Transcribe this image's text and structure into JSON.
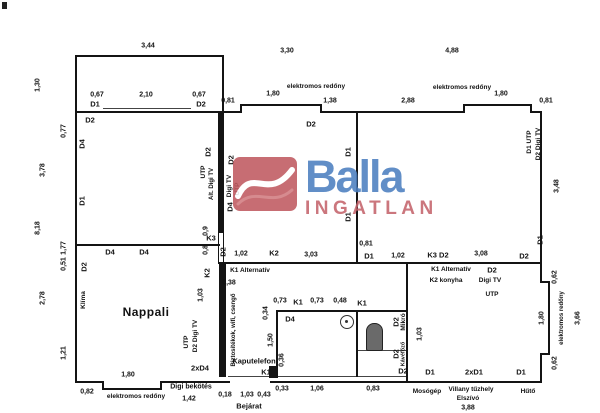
{
  "logo": {
    "brand": "Balla",
    "sub": "INGATLAN",
    "colors": {
      "blue": "#4c7fc0",
      "red": "#c05a60",
      "sub_red": "#c4646c"
    }
  },
  "plan": {
    "line_color": "#141414",
    "rooms": [
      "Nappali",
      "K2 konyha"
    ],
    "walls": [
      [
        75,
        55,
        149,
        58,
        "O",
        "balcony-outline"
      ],
      [
        75,
        111,
        167,
        2,
        "",
        "top-wall"
      ],
      [
        240,
        104,
        2,
        9,
        "",
        "top-wall-step"
      ],
      [
        240,
        104,
        82,
        2,
        "",
        "top-window-recess"
      ],
      [
        320,
        104,
        2,
        9,
        "",
        "top-wall-step"
      ],
      [
        320,
        111,
        145,
        2,
        "",
        "top-wall"
      ],
      [
        463,
        104,
        2,
        9,
        "",
        "top-wall-step"
      ],
      [
        463,
        104,
        69,
        2,
        "",
        "top-window-recess"
      ],
      [
        530,
        104,
        2,
        9,
        "",
        "top-wall-step"
      ],
      [
        530,
        111,
        12,
        2,
        "",
        "top-wall"
      ],
      [
        103,
        108,
        88,
        1,
        "t",
        "balcony-door-line"
      ],
      [
        75,
        111,
        2,
        272,
        "",
        "left-wall"
      ],
      [
        75,
        381,
        29,
        2,
        "",
        "bottom-wall"
      ],
      [
        102,
        381,
        2,
        9,
        "",
        "bottom-wall-step"
      ],
      [
        102,
        388,
        60,
        2,
        "",
        "bottom-window-recess"
      ],
      [
        160,
        381,
        2,
        9,
        "",
        "bottom-wall-step"
      ],
      [
        160,
        381,
        70,
        2,
        "",
        "bottom-wall"
      ],
      [
        228,
        376,
        46,
        1,
        "t",
        "entry-threshold"
      ],
      [
        270,
        381,
        272,
        2,
        "",
        "bottom-wall"
      ],
      [
        540,
        111,
        2,
        172,
        "",
        "right-wall"
      ],
      [
        540,
        281,
        10,
        2,
        "",
        "right-wall-step"
      ],
      [
        548,
        283,
        2,
        72,
        "",
        "right-window-recess"
      ],
      [
        540,
        353,
        10,
        2,
        "",
        "right-wall-step"
      ],
      [
        540,
        355,
        2,
        28,
        "",
        "right-wall"
      ],
      [
        218,
        111,
        6,
        121,
        "",
        "interior-thick-wall"
      ],
      [
        218,
        232,
        6,
        32,
        "o",
        "k3-window"
      ],
      [
        75,
        244,
        145,
        2,
        "",
        "nappali-top-wall"
      ],
      [
        218,
        262,
        324,
        2,
        "",
        "middle-wall"
      ],
      [
        356,
        111,
        2,
        153,
        "",
        "room-divider-wall"
      ],
      [
        219,
        264,
        7,
        113,
        "",
        "hall-thick-wall"
      ],
      [
        276,
        310,
        131,
        2,
        "",
        "bathroom-top-wall"
      ],
      [
        276,
        310,
        2,
        68,
        "",
        "bathroom-left-wall"
      ],
      [
        276,
        376,
        131,
        1,
        "t",
        "bathroom-bottom-wall"
      ],
      [
        356,
        310,
        2,
        67,
        "",
        "bathroom-divider"
      ],
      [
        358,
        350,
        49,
        1,
        "t",
        "wc-shelf-line"
      ],
      [
        406,
        264,
        2,
        119,
        "",
        "kitchen-wall"
      ]
    ],
    "labels": [
      {
        "s": "3,44",
        "x": 148,
        "y": 46,
        "t": "dim"
      },
      {
        "s": "3,30",
        "x": 287,
        "y": 51,
        "t": "dim"
      },
      {
        "s": "4,88",
        "x": 452,
        "y": 51,
        "t": "dim"
      },
      {
        "s": "elektromos redőny",
        "x": 316,
        "y": 87,
        "t": "note"
      },
      {
        "s": "1,80",
        "x": 273,
        "y": 94,
        "t": "dim"
      },
      {
        "s": "1,38",
        "x": 330,
        "y": 101,
        "t": "dim"
      },
      {
        "s": "2,88",
        "x": 408,
        "y": 101,
        "t": "dim"
      },
      {
        "s": "elektromos redőny",
        "x": 462,
        "y": 88,
        "t": "note"
      },
      {
        "s": "1,80",
        "x": 501,
        "y": 94,
        "t": "dim"
      },
      {
        "s": "0,81",
        "x": 546,
        "y": 101,
        "t": "dim"
      },
      {
        "s": "0,81",
        "x": 228,
        "y": 101,
        "t": "dim"
      },
      {
        "s": "0,67",
        "x": 97,
        "y": 95,
        "t": "dim"
      },
      {
        "s": "2,10",
        "x": 146,
        "y": 95,
        "t": "dim"
      },
      {
        "s": "0,67",
        "x": 199,
        "y": 95,
        "t": "dim"
      },
      {
        "s": "D1",
        "x": 95,
        "y": 104,
        "t": "tag"
      },
      {
        "s": "D2",
        "x": 201,
        "y": 104,
        "t": "tag"
      },
      {
        "s": "1,30",
        "x": 38,
        "y": 85,
        "t": "dim",
        "r": 1
      },
      {
        "s": "D2",
        "x": 90,
        "y": 120,
        "t": "tag"
      },
      {
        "s": "0,77",
        "x": 64,
        "y": 131,
        "t": "dim",
        "r": 1
      },
      {
        "s": "D4",
        "x": 82,
        "y": 144,
        "t": "tag",
        "r": 1
      },
      {
        "s": "3,78",
        "x": 43,
        "y": 170,
        "t": "dim",
        "r": 1
      },
      {
        "s": "D1",
        "x": 82,
        "y": 201,
        "t": "tag",
        "r": 1
      },
      {
        "s": "8,18",
        "x": 38,
        "y": 228,
        "t": "dim",
        "r": 1
      },
      {
        "s": "1,77",
        "x": 64,
        "y": 248,
        "t": "dim",
        "r": 1
      },
      {
        "s": "0,51",
        "x": 64,
        "y": 264,
        "t": "dim",
        "r": 1
      },
      {
        "s": "2,78",
        "x": 43,
        "y": 298,
        "t": "dim",
        "r": 1
      },
      {
        "s": "D2",
        "x": 84,
        "y": 267,
        "t": "tag",
        "r": 1
      },
      {
        "s": "Klíma",
        "x": 84,
        "y": 300,
        "t": "note",
        "r": 1
      },
      {
        "s": "1,21",
        "x": 64,
        "y": 353,
        "t": "dim",
        "r": 1
      },
      {
        "s": "Nappali",
        "x": 146,
        "y": 312,
        "t": "room"
      },
      {
        "s": "D4",
        "x": 110,
        "y": 252,
        "t": "tag"
      },
      {
        "s": "D4",
        "x": 144,
        "y": 252,
        "t": "tag"
      },
      {
        "s": "D2",
        "x": 208,
        "y": 152,
        "t": "tag",
        "r": 1
      },
      {
        "s": "UTP",
        "x": 204,
        "y": 172,
        "t": "note",
        "r": 1
      },
      {
        "s": "Alt. Digi TV",
        "x": 212,
        "y": 184,
        "t": "note",
        "r": 1,
        "z": 6
      },
      {
        "s": "D2",
        "x": 231,
        "y": 160,
        "t": "tag",
        "r": 1
      },
      {
        "s": "Digi TV",
        "x": 230,
        "y": 186,
        "t": "note",
        "r": 1
      },
      {
        "s": "UTP",
        "x": 238,
        "y": 189,
        "t": "note",
        "r": 1
      },
      {
        "s": "D4",
        "x": 230,
        "y": 207,
        "t": "tag",
        "r": 1
      },
      {
        "s": "0,9",
        "x": 206,
        "y": 231,
        "t": "dim",
        "r": 1
      },
      {
        "s": "K3",
        "x": 211,
        "y": 238,
        "t": "tag"
      },
      {
        "s": "0,8",
        "x": 206,
        "y": 250,
        "t": "dim",
        "r": 1
      },
      {
        "s": "D2",
        "x": 223,
        "y": 252,
        "t": "tag",
        "r": 1
      },
      {
        "s": "1,02",
        "x": 241,
        "y": 254,
        "t": "dim"
      },
      {
        "s": "K2",
        "x": 274,
        "y": 253,
        "t": "tag"
      },
      {
        "s": "3,03",
        "x": 311,
        "y": 255,
        "t": "dim"
      },
      {
        "s": "0,81",
        "x": 366,
        "y": 244,
        "t": "dim"
      },
      {
        "s": "D1",
        "x": 369,
        "y": 256,
        "t": "tag"
      },
      {
        "s": "1,02",
        "x": 398,
        "y": 256,
        "t": "dim"
      },
      {
        "s": "K3 D2",
        "x": 438,
        "y": 255,
        "t": "tag"
      },
      {
        "s": "3,08",
        "x": 481,
        "y": 254,
        "t": "dim"
      },
      {
        "s": "D2",
        "x": 524,
        "y": 256,
        "t": "tag"
      },
      {
        "s": "D1",
        "x": 540,
        "y": 240,
        "t": "tag",
        "r": 1
      },
      {
        "s": "K2",
        "x": 207,
        "y": 273,
        "t": "tag",
        "r": 1
      },
      {
        "s": "K1 Alternatív",
        "x": 250,
        "y": 271,
        "t": "note"
      },
      {
        "s": "0,38",
        "x": 229,
        "y": 283,
        "t": "dim"
      },
      {
        "s": "K1 Alternatív",
        "x": 451,
        "y": 270,
        "t": "note"
      },
      {
        "s": "K2 konyha",
        "x": 446,
        "y": 281,
        "t": "note"
      },
      {
        "s": "D2",
        "x": 492,
        "y": 270,
        "t": "tag"
      },
      {
        "s": "Digi TV",
        "x": 490,
        "y": 281,
        "t": "note"
      },
      {
        "s": "UTP",
        "x": 492,
        "y": 295,
        "t": "note"
      },
      {
        "s": "D2",
        "x": 311,
        "y": 124,
        "t": "tag"
      },
      {
        "s": "D1",
        "x": 348,
        "y": 152,
        "t": "tag",
        "r": 1
      },
      {
        "s": "D1",
        "x": 348,
        "y": 217,
        "t": "tag",
        "r": 1
      },
      {
        "s": "D1 UTP",
        "x": 530,
        "y": 142,
        "t": "note",
        "r": 1
      },
      {
        "s": "D2 Digi TV",
        "x": 539,
        "y": 144,
        "t": "note",
        "r": 1
      },
      {
        "s": "3,48",
        "x": 557,
        "y": 186,
        "t": "dim",
        "r": 1
      },
      {
        "s": "0,62",
        "x": 555,
        "y": 277,
        "t": "dim",
        "r": 1
      },
      {
        "s": "1,80",
        "x": 542,
        "y": 318,
        "t": "dim",
        "r": 1
      },
      {
        "s": "elektromos redőny",
        "x": 562,
        "y": 318,
        "t": "note",
        "r": 1,
        "z": 6
      },
      {
        "s": "3,66",
        "x": 578,
        "y": 318,
        "t": "dim",
        "r": 1
      },
      {
        "s": "0,62",
        "x": 555,
        "y": 363,
        "t": "dim",
        "r": 1
      },
      {
        "s": "1,03",
        "x": 201,
        "y": 295,
        "t": "dim",
        "r": 1
      },
      {
        "s": "UTP",
        "x": 187,
        "y": 342,
        "t": "note",
        "r": 1
      },
      {
        "s": "D2 Digi TV",
        "x": 196,
        "y": 336,
        "t": "note",
        "r": 1
      },
      {
        "s": "2xD4",
        "x": 200,
        "y": 368,
        "t": "tag"
      },
      {
        "s": "Biztosítékok, wifi, csengő",
        "x": 234,
        "y": 330,
        "t": "note",
        "r": 1,
        "z": 6
      },
      {
        "s": "Kaputelefon",
        "x": 254,
        "y": 361,
        "t": "note",
        "z": 7.5
      },
      {
        "s": "K1",
        "x": 266,
        "y": 372,
        "t": "tag"
      },
      {
        "s": "1,50",
        "x": 271,
        "y": 340,
        "t": "dim",
        "r": 1
      },
      {
        "s": "0,36",
        "x": 282,
        "y": 360,
        "t": "dim",
        "r": 1
      },
      {
        "s": "0,73",
        "x": 280,
        "y": 301,
        "t": "dim"
      },
      {
        "s": "K1",
        "x": 298,
        "y": 302,
        "t": "tag"
      },
      {
        "s": "0,73",
        "x": 317,
        "y": 301,
        "t": "dim"
      },
      {
        "s": "0,48",
        "x": 340,
        "y": 301,
        "t": "dim"
      },
      {
        "s": "K1",
        "x": 362,
        "y": 303,
        "t": "tag"
      },
      {
        "s": "0,34",
        "x": 266,
        "y": 313,
        "t": "dim",
        "r": 1
      },
      {
        "s": "D4",
        "x": 290,
        "y": 319,
        "t": "tag"
      },
      {
        "s": "D2",
        "x": 396,
        "y": 322,
        "t": "tag",
        "r": 1
      },
      {
        "s": "Mikró",
        "x": 404,
        "y": 322,
        "t": "note",
        "r": 1
      },
      {
        "s": "1,03",
        "x": 420,
        "y": 334,
        "t": "dim",
        "r": 1
      },
      {
        "s": "D2",
        "x": 396,
        "y": 354,
        "t": "tag",
        "r": 1
      },
      {
        "s": "Kávéfőző",
        "x": 404,
        "y": 354,
        "t": "note",
        "r": 1,
        "z": 5.5
      },
      {
        "s": "D2",
        "x": 403,
        "y": 371,
        "t": "tag"
      },
      {
        "s": "D1",
        "x": 430,
        "y": 372,
        "t": "tag"
      },
      {
        "s": "2xD1",
        "x": 474,
        "y": 372,
        "t": "tag"
      },
      {
        "s": "D1",
        "x": 521,
        "y": 372,
        "t": "tag"
      },
      {
        "s": "Mosógép",
        "x": 427,
        "y": 392,
        "t": "note"
      },
      {
        "s": "Villany tűzhely",
        "x": 471,
        "y": 390,
        "t": "note"
      },
      {
        "s": "Elszívó",
        "x": 468,
        "y": 399,
        "t": "note"
      },
      {
        "s": "3,88",
        "x": 468,
        "y": 408,
        "t": "dim"
      },
      {
        "s": "Hűtő",
        "x": 528,
        "y": 392,
        "t": "note"
      },
      {
        "s": "0,18",
        "x": 225,
        "y": 395,
        "t": "dim"
      },
      {
        "s": "1,03",
        "x": 247,
        "y": 395,
        "t": "dim"
      },
      {
        "s": "0,43",
        "x": 264,
        "y": 395,
        "t": "dim"
      },
      {
        "s": "0,33",
        "x": 282,
        "y": 389,
        "t": "dim"
      },
      {
        "s": "1,06",
        "x": 317,
        "y": 389,
        "t": "dim"
      },
      {
        "s": "0,83",
        "x": 373,
        "y": 389,
        "t": "dim"
      },
      {
        "s": "Bejárat",
        "x": 249,
        "y": 406,
        "t": "note",
        "z": 7.5
      },
      {
        "s": "Digi bekötés",
        "x": 191,
        "y": 387,
        "t": "note",
        "z": 7
      },
      {
        "s": "1,42",
        "x": 189,
        "y": 399,
        "t": "dim"
      },
      {
        "s": "0,82",
        "x": 87,
        "y": 392,
        "t": "dim"
      },
      {
        "s": "1,80",
        "x": 128,
        "y": 375,
        "t": "dim"
      },
      {
        "s": "elektromos redőny",
        "x": 136,
        "y": 397,
        "t": "note"
      }
    ]
  }
}
